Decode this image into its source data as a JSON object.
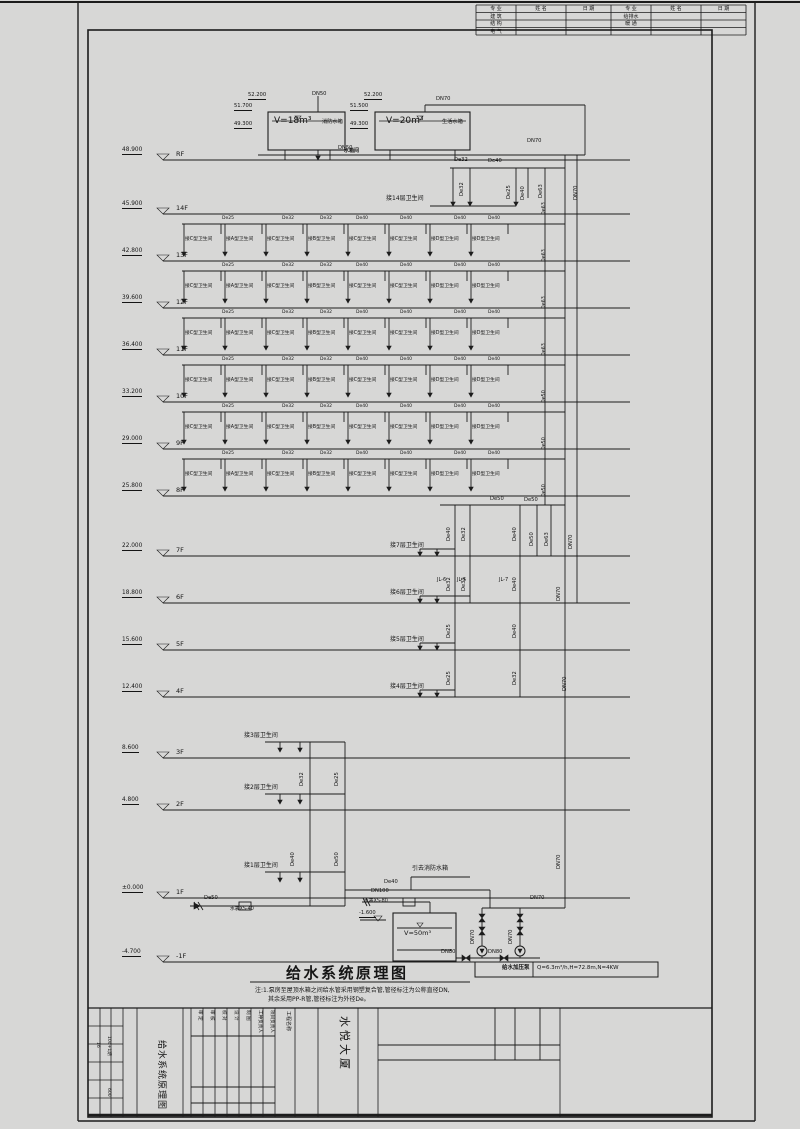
{
  "revision_table": {
    "headers": [
      "专 业",
      "姓 名",
      "日 期",
      "专 业",
      "姓 名",
      "日 期"
    ],
    "rows": [
      [
        "建 筑",
        "给排水"
      ],
      [
        "结 构",
        "暖 通"
      ],
      [
        "电 气",
        ""
      ]
    ]
  },
  "tanks": {
    "fire": {
      "volume": "V=18m³",
      "name": "消防水箱",
      "elev_top": "52.200",
      "elev_lid": "51.700",
      "elev_bottom": "49.300",
      "outlet": "DN50"
    },
    "domestic": {
      "volume": "V=20m³",
      "name": "生活水箱",
      "elev_top": "52.200",
      "elev_lid": "51.500",
      "elev_bottom": "49.300",
      "outlet": "DN70"
    },
    "room": "水箱间"
  },
  "floors": [
    {
      "label": "RF",
      "elev": "48.900"
    },
    {
      "label": "14F",
      "elev": "45.900"
    },
    {
      "label": "13F",
      "elev": "42.800"
    },
    {
      "label": "12F",
      "elev": "39.600"
    },
    {
      "label": "11F",
      "elev": "36.400"
    },
    {
      "label": "10F",
      "elev": "33.200"
    },
    {
      "label": "9F",
      "elev": "29.000"
    },
    {
      "label": "8F",
      "elev": "25.800"
    },
    {
      "label": "7F",
      "elev": "22.000"
    },
    {
      "label": "6F",
      "elev": "18.800"
    },
    {
      "label": "5F",
      "elev": "15.600"
    },
    {
      "label": "4F",
      "elev": "12.400"
    },
    {
      "label": "3F",
      "elev": "8.600"
    },
    {
      "label": "2F",
      "elev": "4.800"
    },
    {
      "label": "1F",
      "elev": "±0.000"
    },
    {
      "label": "-1F",
      "elev": "-4.700"
    }
  ],
  "branch_row": {
    "labels": [
      "接C型卫生间",
      "接A型卫生间",
      "接C型卫生间",
      "接B型卫生间",
      "接C型卫生间",
      "接C型卫生间",
      "接D型卫生间",
      "接D型卫生间"
    ],
    "pipes": [
      "De25",
      "De32",
      "De32",
      "De40",
      "De40",
      "De40",
      "De40"
    ],
    "riser_sizes": [
      "De63",
      "De63",
      "De63",
      "De63",
      "De50",
      "De50",
      "De50"
    ]
  },
  "branch_14f": "接14层卫生间",
  "mid_branches": [
    "接7层卫生间",
    "接6层卫生间",
    "接5层卫生间",
    "接4层卫生间"
  ],
  "low_branches": [
    "接3层卫生间",
    "接2层卫生间",
    "接1层卫生间"
  ],
  "riser_tags": [
    "JL-6",
    "JL-5",
    "JL-7"
  ],
  "pipe_labels_h": [
    {
      "t": "DN50",
      "x": 312,
      "y": 92
    },
    {
      "t": "DN70",
      "x": 436,
      "y": 97
    },
    {
      "t": "DN50",
      "x": 338,
      "y": 146
    },
    {
      "t": "De32",
      "x": 454,
      "y": 158
    },
    {
      "t": "De40",
      "x": 488,
      "y": 159
    },
    {
      "t": "DN70",
      "x": 527,
      "y": 139
    },
    {
      "t": "De50",
      "x": 490,
      "y": 497
    },
    {
      "t": "De50",
      "x": 524,
      "y": 498
    },
    {
      "t": "De50",
      "x": 204,
      "y": 896
    },
    {
      "t": "De40",
      "x": 384,
      "y": 880
    },
    {
      "t": "DN100",
      "x": 371,
      "y": 889
    },
    {
      "t": "DN70",
      "x": 530,
      "y": 896
    },
    {
      "t": "DN80",
      "x": 441,
      "y": 950
    },
    {
      "t": "DN80",
      "x": 488,
      "y": 950
    }
  ],
  "pipe_labels_v": [
    {
      "t": "De32",
      "x": 460,
      "y": 196
    },
    {
      "t": "De25",
      "x": 507,
      "y": 199
    },
    {
      "t": "De40",
      "x": 521,
      "y": 200
    },
    {
      "t": "De63",
      "x": 539,
      "y": 198
    },
    {
      "t": "DN70",
      "x": 574,
      "y": 200
    },
    {
      "t": "De40",
      "x": 447,
      "y": 541
    },
    {
      "t": "De32",
      "x": 462,
      "y": 541
    },
    {
      "t": "De40",
      "x": 513,
      "y": 541
    },
    {
      "t": "De50",
      "x": 530,
      "y": 546
    },
    {
      "t": "De63",
      "x": 545,
      "y": 546
    },
    {
      "t": "DN70",
      "x": 569,
      "y": 549
    },
    {
      "t": "De32",
      "x": 447,
      "y": 591
    },
    {
      "t": "De32",
      "x": 462,
      "y": 591
    },
    {
      "t": "De40",
      "x": 513,
      "y": 591
    },
    {
      "t": "DN70",
      "x": 557,
      "y": 601
    },
    {
      "t": "De25",
      "x": 447,
      "y": 638
    },
    {
      "t": "De40",
      "x": 513,
      "y": 638
    },
    {
      "t": "De25",
      "x": 447,
      "y": 685
    },
    {
      "t": "De32",
      "x": 513,
      "y": 685
    },
    {
      "t": "DN70",
      "x": 563,
      "y": 691
    },
    {
      "t": "De32",
      "x": 300,
      "y": 786
    },
    {
      "t": "De25",
      "x": 335,
      "y": 786
    },
    {
      "t": "De40",
      "x": 291,
      "y": 866
    },
    {
      "t": "De50",
      "x": 335,
      "y": 866
    },
    {
      "t": "DN70",
      "x": 557,
      "y": 869
    },
    {
      "t": "DN70",
      "x": 471,
      "y": 944
    },
    {
      "t": "DN70",
      "x": 509,
      "y": 944
    }
  ],
  "equipment": {
    "meter_small": "水表XS-40",
    "meter_large": "水表XS-80",
    "supply_dn": "DN100",
    "sump_tank_volume": "V=50m³",
    "sump_elev": "-1.600",
    "to_fire_tank": "引去消防水箱",
    "pump_spec_label": "给水加压泵",
    "pump_spec": "Q=6.3m³/h,H=72.8m,N=4KW"
  },
  "title": {
    "text": "给水系统原理图"
  },
  "notes": [
    "注:1.泵房至屋顶水箱之间给水管采用钢塑复合管,管径标注为公称直径DN,",
    "其余采用PP-R管,管径标注为外径De。"
  ],
  "titleblock": {
    "drawing_name": "给水系统原理图",
    "project_name": "水悦大厦",
    "project_label": "工程名称",
    "columns": [
      "审 定",
      "审 核",
      "校 对",
      "设 计",
      "制 图",
      "工种负责人",
      "项目负责人"
    ],
    "left_cells": [
      "16",
      "104+1期",
      "600"
    ]
  }
}
